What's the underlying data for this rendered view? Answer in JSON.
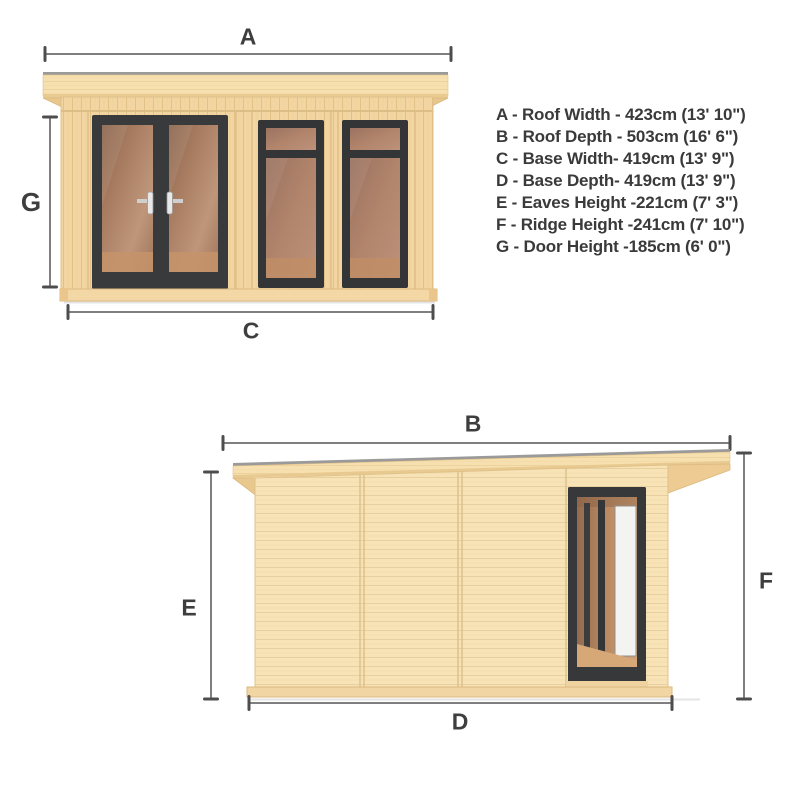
{
  "legend": {
    "items": [
      "A - Roof Width -  423cm (13' 10\")",
      "B - Roof Depth - 503cm (16' 6\")",
      "C - Base Width- 419cm (13' 9\")",
      "D - Base Depth- 419cm (13' 9\")",
      "E - Eaves Height -221cm (7' 3\")",
      "F - Ridge Height -241cm (7' 10\")",
      "G - Door Height -185cm (6' 0\")"
    ]
  },
  "labels": {
    "a": "A",
    "b": "B",
    "c": "C",
    "d": "D",
    "e": "E",
    "f": "F",
    "g": "G"
  },
  "dimensions": {
    "A": {
      "name": "Roof Width",
      "cm": 423,
      "imperial": "13' 10\""
    },
    "B": {
      "name": "Roof Depth",
      "cm": 503,
      "imperial": "16' 6\""
    },
    "C": {
      "name": "Base Width",
      "cm": 419,
      "imperial": "13' 9\""
    },
    "D": {
      "name": "Base Depth",
      "cm": 419,
      "imperial": "13' 9\""
    },
    "E": {
      "name": "Eaves Height",
      "cm": 221,
      "imperial": "7' 3\""
    },
    "F": {
      "name": "Ridge Height",
      "cm": 241,
      "imperial": "7' 10\""
    },
    "G": {
      "name": "Door Height",
      "cm": 185,
      "imperial": "6' 0\""
    }
  },
  "colors": {
    "wood_front_wall": "#f2d5a1",
    "wood_side_wall": "#f7e3b6",
    "wood_roof": "#f7e0af",
    "wood_edge": "#d9b87e",
    "frame_dark": "#36383a",
    "glass_brown": "#ae8165",
    "roof_felt_grey": "#9a9a9a",
    "dimension_line": "#7f7f7f",
    "dimension_tick": "#4d4d4d",
    "label_text": "#3e3e3e",
    "background": "#ffffff"
  }
}
